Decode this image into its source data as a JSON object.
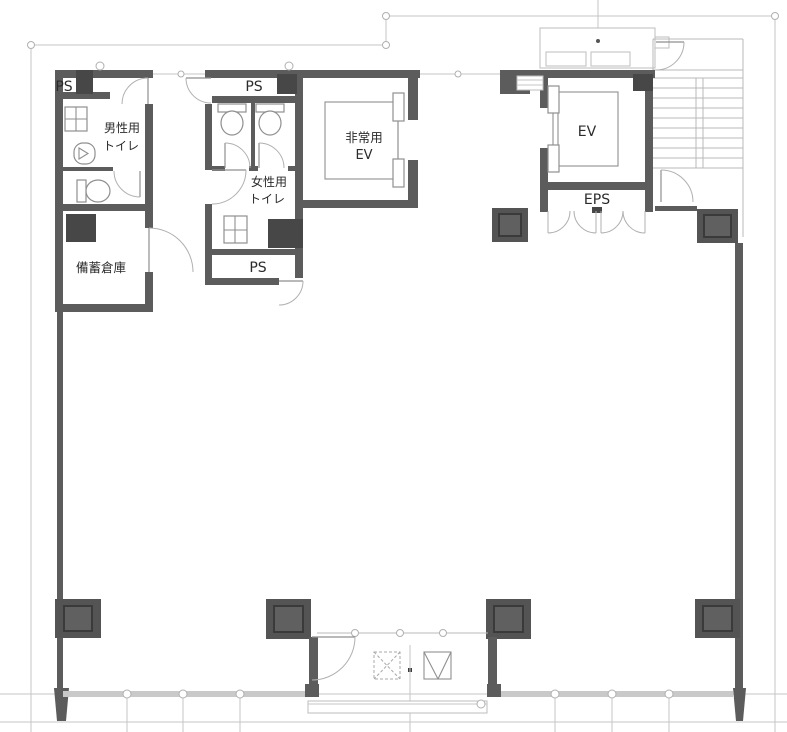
{
  "plan": {
    "type": "building-floor-plan",
    "rooms": {
      "ps_left": "PS",
      "ps_mid_top": "PS",
      "ps_mid_bottom": "PS",
      "mens_toilet": {
        "line1": "男性用",
        "line2": "トイレ"
      },
      "womens_toilet": {
        "line1": "女性用",
        "line2": "トイレ"
      },
      "storage": "備蓄倉庫",
      "emergency_elevator": {
        "line1": "非常用",
        "line2": "EV"
      },
      "elevator": "EV",
      "eps": "EPS"
    },
    "colors": {
      "wall": "#5c5c5c",
      "shaft_fill": "#474747",
      "column": "#545454",
      "light_line": "#c6c6c6",
      "fixture_line": "#8f8f8f",
      "text": "#2b2b2b",
      "background": "#ffffff"
    }
  }
}
